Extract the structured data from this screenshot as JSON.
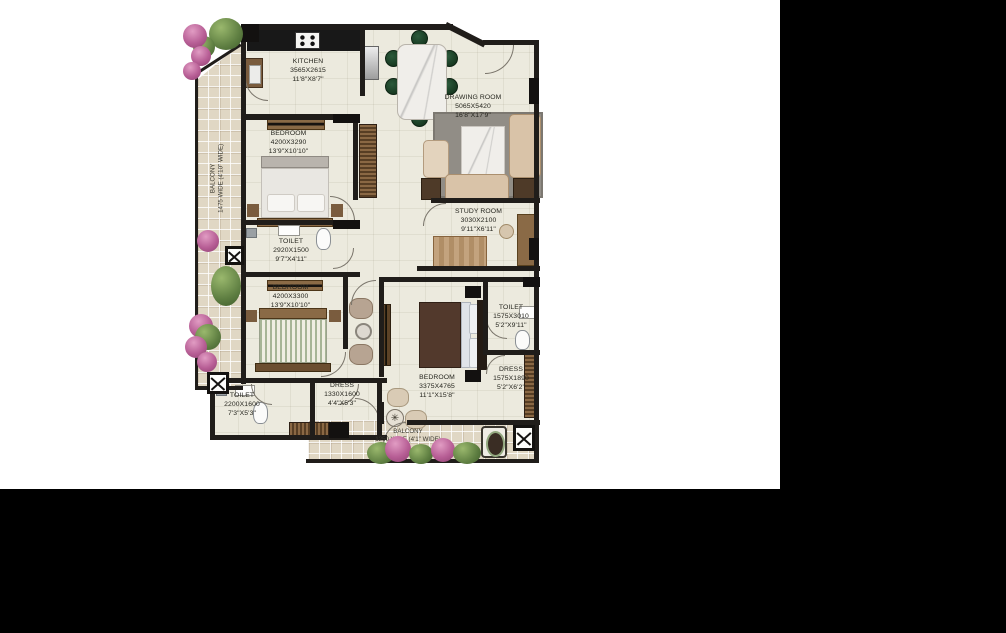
{
  "figure": "apartment-floor-plan",
  "plan": {
    "rooms": [
      {
        "id": "kitchen",
        "name": "KITCHEN",
        "dim_mm": "3565X2615",
        "dim_ft": "11'8\"X8'7\""
      },
      {
        "id": "drawing-room",
        "name": "DRAWING ROOM",
        "dim_mm": "5065X5420",
        "dim_ft": "16'8\"X17'9\""
      },
      {
        "id": "bedroom-1",
        "name": "BEDROOM",
        "dim_mm": "4200X3290",
        "dim_ft": "13'9\"X10'10\""
      },
      {
        "id": "toilet-1",
        "name": "TOILET",
        "dim_mm": "2920X1500",
        "dim_ft": "9'7\"X4'11\""
      },
      {
        "id": "study-room",
        "name": "STUDY ROOM",
        "dim_mm": "3030X2100",
        "dim_ft": "9'11\"X6'11\""
      },
      {
        "id": "bedroom-2",
        "name": "BEDROOM",
        "dim_mm": "4200X3300",
        "dim_ft": "13'9\"X10'10\""
      },
      {
        "id": "bedroom-3",
        "name": "BEDROOM",
        "dim_mm": "3375X4765",
        "dim_ft": "11'1\"X15'8\""
      },
      {
        "id": "toilet-2",
        "name": "TOILET",
        "dim_mm": "1575X3010",
        "dim_ft": "5'2\"X9'11\""
      },
      {
        "id": "dress-2",
        "name": "DRESS",
        "dim_mm": "1575X1890",
        "dim_ft": "5'2\"X6'2\""
      },
      {
        "id": "toilet-3",
        "name": "TOILET",
        "dim_mm": "2200X1600",
        "dim_ft": "7'3\"X5'3\""
      },
      {
        "id": "dress-1",
        "name": "DRESS",
        "dim_mm": "1330X1600",
        "dim_ft": "4'4\"X5'3\""
      }
    ],
    "balconies": [
      {
        "id": "balcony-left",
        "name": "BALCONY",
        "size": "1475 WIDE (4'10\" WIDE)"
      },
      {
        "id": "balcony-bottom",
        "name": "BALCONY",
        "size": "1250 WIDE (4'1\" WIDE)"
      }
    ]
  },
  "colors": {
    "background": "#ffffff",
    "masking_black": "#000000",
    "walls": "#201d1a",
    "floor": "#eceade",
    "balcony_tiles": "#e0d7c4",
    "wood": "#8a6844",
    "dining_chair_green": "#1f4731",
    "master_bed_brown": "#52392c",
    "plant_green": "#5f7f42",
    "plant_pink": "#b75e95"
  }
}
